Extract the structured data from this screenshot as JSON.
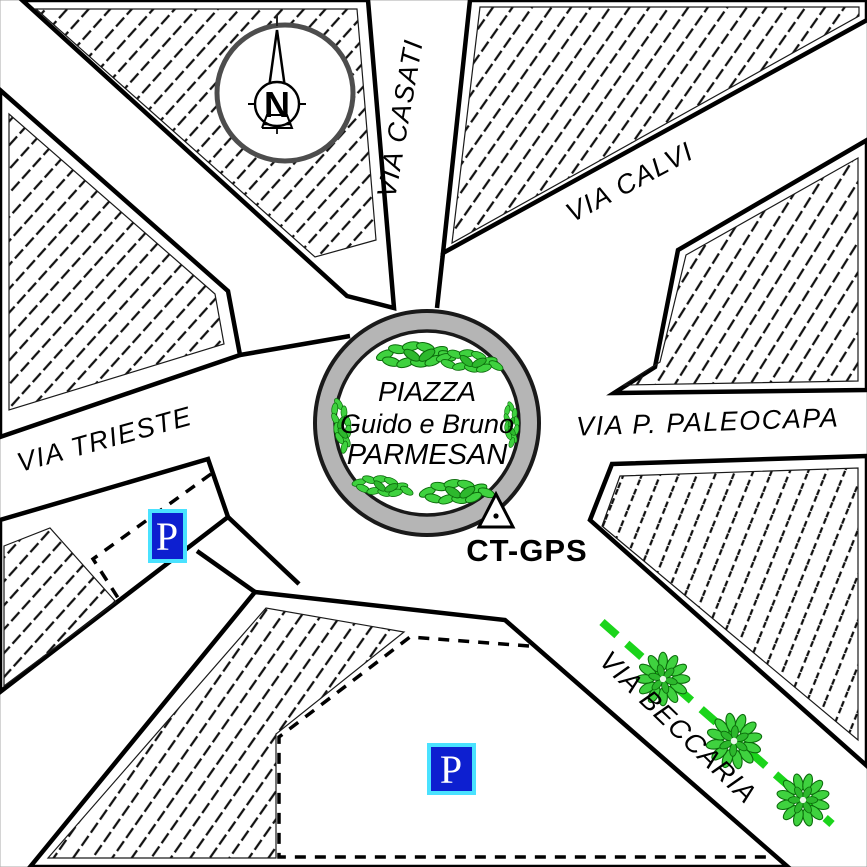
{
  "streets": [
    {
      "name": "casati",
      "label": "VIA CASATI"
    },
    {
      "name": "calvi",
      "label": "VIA CALVI"
    },
    {
      "name": "paleocapa",
      "label": "VIA P. PALEOCAPA"
    },
    {
      "name": "beccaria",
      "label": "VIA BECCARIA"
    },
    {
      "name": "trieste",
      "label": "VIA TRIESTE"
    }
  ],
  "piazza": {
    "line1": "PIAZZA",
    "line2": "Guido e Bruno",
    "line3": "PARMESAN"
  },
  "gps_marker": {
    "label": "CT-GPS"
  },
  "compass": {
    "north_label": "N"
  },
  "parking_signs": [
    {
      "symbol": "P"
    },
    {
      "symbol": "P"
    }
  ],
  "icons": [
    "compass-rose-icon",
    "gps-station-triangle-icon",
    "parking-sign-icon",
    "tree-icon",
    "hedge-icon"
  ],
  "colors": {
    "vegetation_green": "#3fd23f",
    "vegetation_outline": "#0b6b0b",
    "route_dashed_green": "#1bd41b",
    "roundabout_ring_gray": "#b5b5b5",
    "parking_blue": "#0d1fd0",
    "parking_border_cyan": "#4ae2ff",
    "hatch_line_black": "#111111"
  }
}
